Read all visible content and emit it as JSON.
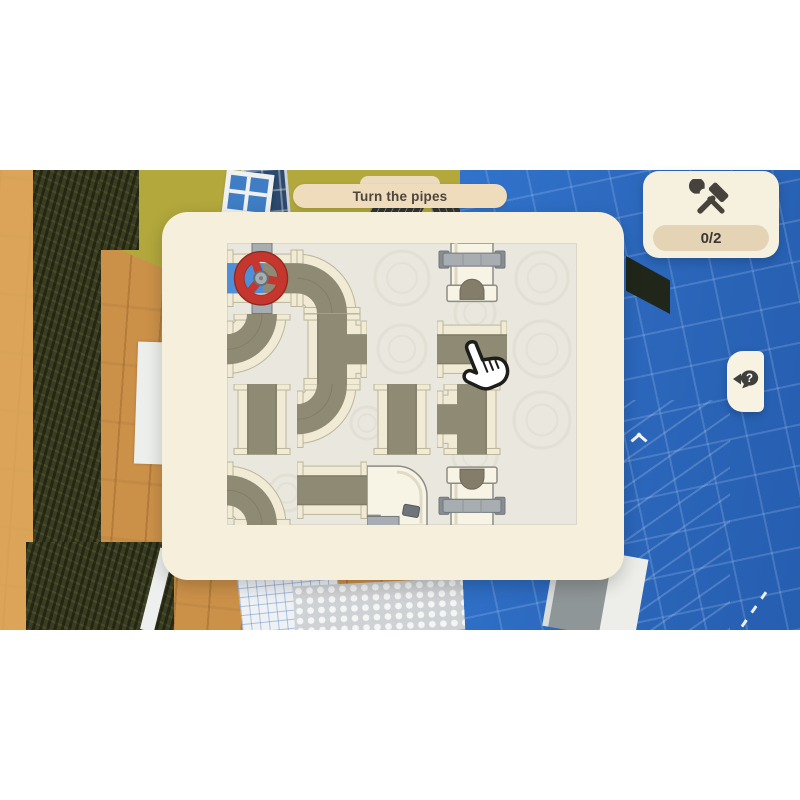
{
  "hud": {
    "objective_banner": {
      "label": "Turn the pipes"
    },
    "secondary_banner": {
      "label": ""
    },
    "progress": {
      "count": "0/2",
      "icon": "hammer-wrench-icon"
    },
    "hint_button": {
      "icon": "question-bubble-icon"
    }
  },
  "puzzle": {
    "grid": {
      "cols": 5,
      "rows": 4
    },
    "board": {
      "x": 227,
      "y": 243,
      "width": 350,
      "height": 282
    },
    "tiles": [
      {
        "id": "r0c0",
        "row": 0,
        "col": 0,
        "type": "start-valve",
        "openings": [
          "left",
          "right"
        ],
        "filled": "water-left",
        "fixed": true
      },
      {
        "id": "r0c1",
        "row": 0,
        "col": 1,
        "type": "elbow",
        "openings": [
          "left",
          "bottom"
        ],
        "fixed": false
      },
      {
        "id": "r0c3",
        "row": 0,
        "col": 3,
        "type": "end-cap",
        "facing": "down",
        "material": "white",
        "fixed": true
      },
      {
        "id": "r1c0",
        "row": 1,
        "col": 0,
        "type": "elbow",
        "openings": [
          "top",
          "left"
        ],
        "fixed": false
      },
      {
        "id": "r1c1",
        "row": 1,
        "col": 1,
        "type": "tee",
        "openings": [
          "top",
          "bottom",
          "right"
        ],
        "fixed": false
      },
      {
        "id": "r1c3",
        "row": 1,
        "col": 3,
        "type": "straight",
        "openings": [
          "left",
          "right"
        ],
        "fixed": false
      },
      {
        "id": "r2c0",
        "row": 2,
        "col": 0,
        "type": "straight",
        "openings": [
          "top",
          "bottom"
        ],
        "fixed": false
      },
      {
        "id": "r2c1",
        "row": 2,
        "col": 1,
        "type": "elbow",
        "openings": [
          "top",
          "left"
        ],
        "fixed": false
      },
      {
        "id": "r2c2",
        "row": 2,
        "col": 2,
        "type": "straight",
        "openings": [
          "top",
          "bottom"
        ],
        "fixed": false
      },
      {
        "id": "r2c3",
        "row": 2,
        "col": 3,
        "type": "tee",
        "openings": [
          "top",
          "bottom",
          "left"
        ],
        "fixed": false
      },
      {
        "id": "r3c0",
        "row": 3,
        "col": 0,
        "type": "elbow",
        "openings": [
          "left",
          "bottom"
        ],
        "fixed": false
      },
      {
        "id": "r3c1",
        "row": 3,
        "col": 1,
        "type": "straight",
        "openings": [
          "left",
          "right"
        ],
        "fixed": false
      },
      {
        "id": "r3c2",
        "row": 3,
        "col": 2,
        "type": "elbow-white",
        "openings": [
          "left",
          "bottom-edge"
        ],
        "material": "white",
        "fixed": true
      },
      {
        "id": "r3c3",
        "row": 3,
        "col": 3,
        "type": "end-cap",
        "facing": "up",
        "material": "white",
        "fixed": true
      }
    ]
  },
  "cursor": {
    "type": "hand-pointer",
    "x": 466,
    "y": 340
  },
  "colors": {
    "water": "#4f8fd9",
    "valve_red": "#c5372e",
    "valve_red_dark": "#93291f",
    "pipe_channel": "#8f8a74",
    "pipe_channel_dark": "#6e6a59",
    "pipe_wall": "#f1ebd5",
    "pipe_wall_edge": "#bdb69b",
    "white_pipe": "#f8f4e5",
    "white_pipe_edge": "#8d8d84",
    "metal": "#a7adb0",
    "metal_edge": "#72787d",
    "arch_dark": "#837d69",
    "panel": "#f5efdc",
    "banner": "#eedcbd",
    "counter_pill": "#e4d3b4",
    "blueprint_blue": "#2b66ba",
    "board_bg": "#e9e7de"
  }
}
